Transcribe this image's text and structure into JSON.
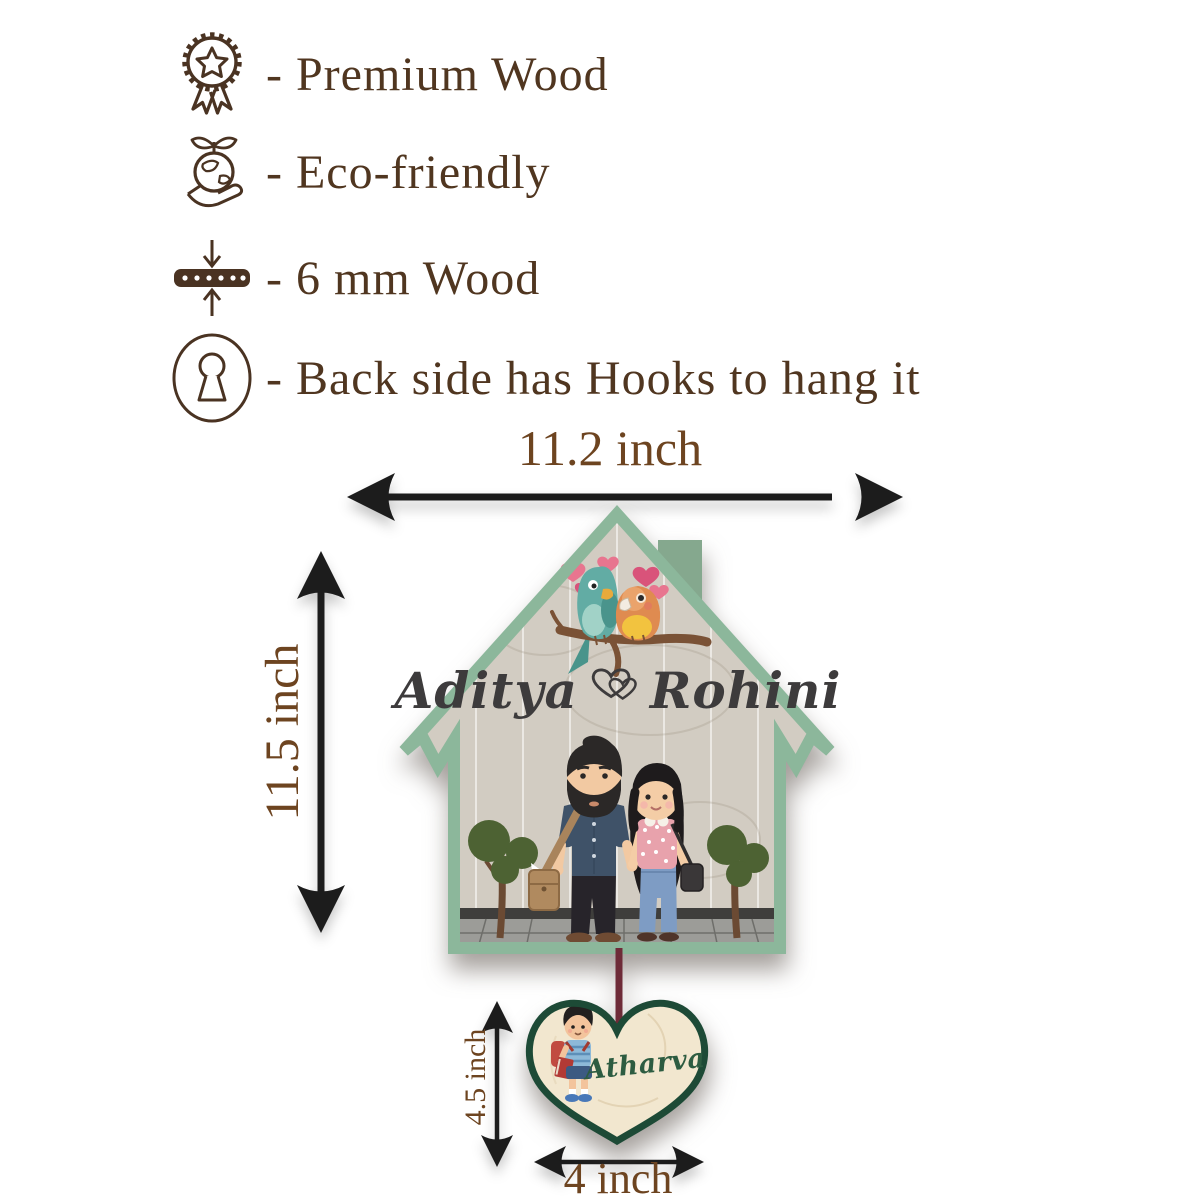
{
  "features": [
    {
      "icon": "award-medal-icon",
      "label": "- Premium Wood"
    },
    {
      "icon": "eco-friendly-icon",
      "label": "- Eco-friendly"
    },
    {
      "icon": "wood-thickness-icon",
      "label": "- 6 mm Wood"
    },
    {
      "icon": "keyhole-icon",
      "label": "- Back side has Hooks to hang it"
    }
  ],
  "dimensions": {
    "plaque_width": "11.2 inch",
    "plaque_height": "11.5 inch",
    "pendant_height": "4.5 inch",
    "pendant_width": "4 inch"
  },
  "plaque": {
    "couple_name_left": "Aditya",
    "couple_name_right": "Rohini",
    "pendant_child_name": "Atharva"
  },
  "colors": {
    "feature_text_brown": "#503620",
    "dimension_text_brown": "#6d4420",
    "arrow_black": "#1c1c1c",
    "plaque_border_green": "#8cb79b",
    "chimney_green": "#85a88e",
    "plaque_wood": "#d2ccc2",
    "pendant_border_green": "#1d4a36",
    "pendant_wood": "#f2e7cf",
    "cord_maroon": "#6e2b38",
    "couple_name_charcoal": "#3d3b3c",
    "child_name_green": "#2d5c41"
  }
}
